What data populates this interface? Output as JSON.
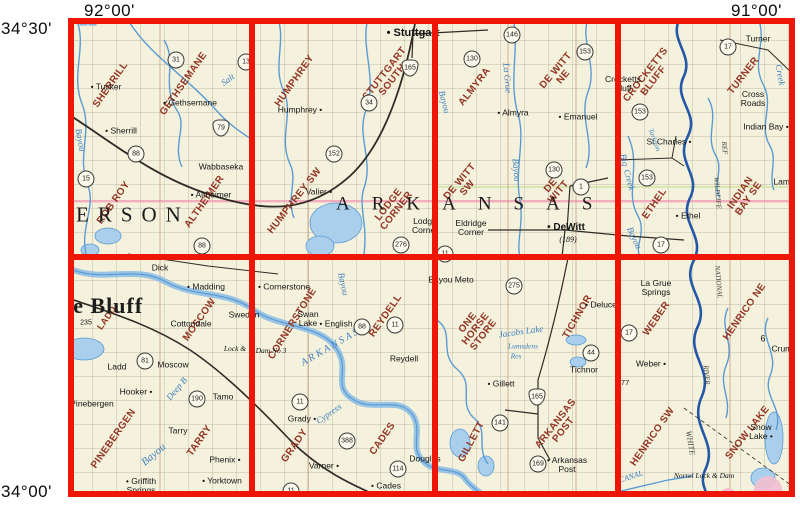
{
  "coord_labels": {
    "top_left_lon": "92°00'",
    "top_right_lon": "91°00'",
    "left_top_lat": "34°30'",
    "left_bottom_lat": "34°00'"
  },
  "map": {
    "bg": "#f4f2dc",
    "grid_color": "#ed1607",
    "quad_color": "#943525",
    "water_color": "#3f7fc1",
    "labels": {
      "quads": [
        {
          "lines": [
            "SHERRILL"
          ],
          "x": 43,
          "y": 67,
          "rot": -55
        },
        {
          "lines": [
            "GETHSEMANE"
          ],
          "x": 116,
          "y": 66,
          "rot": -55
        },
        {
          "lines": [
            "ROB ROY"
          ],
          "x": 46,
          "y": 185,
          "rot": -55
        },
        {
          "lines": [
            "ALTHEIMER"
          ],
          "x": 137,
          "y": 184,
          "rot": -55
        },
        {
          "lines": [
            "HUMPHREY"
          ],
          "x": 227,
          "y": 63,
          "rot": -55
        },
        {
          "lines": [
            "STUTTGART",
            "SOUTH"
          ],
          "x": 321,
          "y": 59,
          "rot": -52
        },
        {
          "lines": [
            "HUMPHREY SW"
          ],
          "x": 227,
          "y": 183,
          "rot": -52
        },
        {
          "lines": [
            "LODGE",
            "CORNER"
          ],
          "x": 325,
          "y": 190,
          "rot": -52
        },
        {
          "lines": [
            "ALMYRA"
          ],
          "x": 407,
          "y": 69,
          "rot": -52
        },
        {
          "lines": [
            "DE WITT",
            "NE"
          ],
          "x": 492,
          "y": 56,
          "rot": -50
        },
        {
          "lines": [
            "DE WITT",
            "SW"
          ],
          "x": 396,
          "y": 167,
          "rot": -50
        },
        {
          "lines": [
            "DE",
            "WITT"
          ],
          "x": 487,
          "y": 171,
          "rot": -50
        },
        {
          "lines": [
            "CROCKETTS",
            "BLUFF"
          ],
          "x": 582,
          "y": 60,
          "rot": -52
        },
        {
          "lines": [
            "TURNER"
          ],
          "x": 676,
          "y": 58,
          "rot": -52
        },
        {
          "lines": [
            "ETHEL"
          ],
          "x": 587,
          "y": 186,
          "rot": -55
        },
        {
          "lines": [
            "INDIAN",
            "BAY SE"
          ],
          "x": 677,
          "y": 178,
          "rot": -55
        },
        {
          "lines": [
            "LADD"
          ],
          "x": 39,
          "y": 300,
          "rot": -55,
          "size": 9
        },
        {
          "lines": [
            "MOSCOW"
          ],
          "x": 132,
          "y": 302,
          "rot": -55
        },
        {
          "lines": [
            "PINEBERGEN"
          ],
          "x": 46,
          "y": 421,
          "rot": -55
        },
        {
          "lines": [
            "TARRY"
          ],
          "x": 132,
          "y": 423,
          "rot": -55
        },
        {
          "lines": [
            "CORNERSTONE"
          ],
          "x": 225,
          "y": 306,
          "rot": -58
        },
        {
          "lines": [
            "REYDELL"
          ],
          "x": 318,
          "y": 298,
          "rot": -55
        },
        {
          "lines": [
            "GRADY"
          ],
          "x": 227,
          "y": 428,
          "rot": -55
        },
        {
          "lines": [
            "CADES"
          ],
          "x": 315,
          "y": 421,
          "rot": -55
        },
        {
          "lines": [
            "ONE",
            "HORSE",
            "STORE"
          ],
          "x": 408,
          "y": 311,
          "rot": -52
        },
        {
          "lines": [
            "TICHNOR"
          ],
          "x": 510,
          "y": 299,
          "rot": -60
        },
        {
          "lines": [
            "GILLETT"
          ],
          "x": 404,
          "y": 424,
          "rot": -62
        },
        {
          "lines": [
            "ARKANSAS",
            "POST"
          ],
          "x": 492,
          "y": 409,
          "rot": -52
        },
        {
          "lines": [
            "WEBER"
          ],
          "x": 589,
          "y": 301,
          "rot": -55
        },
        {
          "lines": [
            "HENRICO NE"
          ],
          "x": 677,
          "y": 294,
          "rot": -55
        },
        {
          "lines": [
            "HENRICO SW"
          ],
          "x": 585,
          "y": 419,
          "rot": -55
        },
        {
          "lines": [
            "SNOW LAKE"
          ],
          "x": 680,
          "y": 415,
          "rot": -52
        }
      ],
      "towns": [
        {
          "t": "Tucker",
          "x": 38,
          "y": 69,
          "dot": "left"
        },
        {
          "t": "Gethsemane",
          "x": 122,
          "y": 85,
          "dot": "left"
        },
        {
          "t": "Sherrill",
          "x": 53,
          "y": 113,
          "dot": "left"
        },
        {
          "t": "Wabbaseka",
          "x": 153,
          "y": 149
        },
        {
          "t": "Altheimer",
          "x": 143,
          "y": 177,
          "dot": "left"
        },
        {
          "t": "Stuttgart",
          "x": 345,
          "y": 16,
          "dot": "left",
          "size": 11,
          "b": true
        },
        {
          "t": "Humphrey",
          "x": 232,
          "y": 92,
          "dot": "right"
        },
        {
          "t": "Valier",
          "x": 251,
          "y": 174,
          "dot": "right"
        },
        {
          "lines": [
            "Lodge",
            "Corner"
          ],
          "x": 357,
          "y": 208
        },
        {
          "lines": [
            "Eldridge",
            "Corner"
          ],
          "x": 403,
          "y": 210
        },
        {
          "t": "Almyra",
          "x": 445,
          "y": 95,
          "dot": "left"
        },
        {
          "t": "Emanuel",
          "x": 510,
          "y": 99,
          "dot": "left"
        },
        {
          "t": "DeWitt",
          "x": 498,
          "y": 210,
          "dot": "left",
          "size": 10,
          "b": true
        },
        {
          "t": "(189)",
          "x": 500,
          "y": 222,
          "i": true,
          "size": 8
        },
        {
          "lines": [
            "Crocketts",
            "Bluff"
          ],
          "x": 555,
          "y": 66
        },
        {
          "t": "Turner",
          "x": 690,
          "y": 21
        },
        {
          "lines": [
            "Cross",
            "Roads"
          ],
          "x": 685,
          "y": 81
        },
        {
          "t": "Indian Bay",
          "x": 698,
          "y": 109,
          "dot": "right"
        },
        {
          "t": "St Charles",
          "x": 601,
          "y": 124,
          "dot": "right"
        },
        {
          "t": "Ethel",
          "x": 620,
          "y": 198,
          "dot": "left"
        },
        {
          "t": "Lamb",
          "x": 716,
          "y": 164
        },
        {
          "t": "Dick",
          "x": 92,
          "y": 250
        },
        {
          "t": "Madding",
          "x": 138,
          "y": 269,
          "dot": "left"
        },
        {
          "t": "Cottondale",
          "x": 123,
          "y": 306
        },
        {
          "t": "Sweden",
          "x": 176,
          "y": 297
        },
        {
          "t": "Ladd",
          "x": 49,
          "y": 349
        },
        {
          "t": "Moscow",
          "x": 105,
          "y": 347
        },
        {
          "t": "Lock &",
          "x": 167,
          "y": 331,
          "size": 7.5,
          "i": true
        },
        {
          "t": "Hooker",
          "x": 68,
          "y": 374,
          "dot": "right"
        },
        {
          "t": "Pinebergen",
          "x": 24,
          "y": 386
        },
        {
          "t": "Tamo",
          "x": 155,
          "y": 379
        },
        {
          "t": "Tarry",
          "x": 110,
          "y": 413
        },
        {
          "t": "Phenix",
          "x": 157,
          "y": 442,
          "dot": "right"
        },
        {
          "t": "Yorktown",
          "x": 154,
          "y": 463,
          "dot": "left"
        },
        {
          "lines": [
            "Griffith",
            "Springs"
          ],
          "x": 73,
          "y": 468,
          "dot": "left"
        },
        {
          "t": "Cornerstone",
          "x": 216,
          "y": 269,
          "dot": "left"
        },
        {
          "lines": [
            "Swan",
            "Lake"
          ],
          "x": 240,
          "y": 301
        },
        {
          "t": "English",
          "x": 268,
          "y": 306,
          "dot": "left"
        },
        {
          "t": "Dam No 3",
          "x": 203,
          "y": 333,
          "size": 7.5,
          "i": true
        },
        {
          "t": "Reydell",
          "x": 336,
          "y": 341
        },
        {
          "t": "Grady",
          "x": 234,
          "y": 401,
          "dot": "right"
        },
        {
          "t": "Varner",
          "x": 256,
          "y": 448,
          "dot": "right"
        },
        {
          "t": "Cades",
          "x": 318,
          "y": 468,
          "dot": "left"
        },
        {
          "t": "Douglas",
          "x": 357,
          "y": 441
        },
        {
          "t": "Bayou Meto",
          "x": 383,
          "y": 262
        },
        {
          "t": "Deluce",
          "x": 533,
          "y": 287,
          "dot": "left"
        },
        {
          "t": "Tichnor",
          "x": 516,
          "y": 352
        },
        {
          "t": "Gillett",
          "x": 433,
          "y": 366,
          "dot": "left"
        },
        {
          "lines": [
            "Arkansas",
            "Post"
          ],
          "x": 499,
          "y": 447,
          "dot": "left"
        },
        {
          "lines": [
            "La Grue",
            "Springs"
          ],
          "x": 588,
          "y": 270
        },
        {
          "t": "Weber",
          "x": 583,
          "y": 346,
          "dot": "right"
        },
        {
          "t": "Crumrod",
          "x": 720,
          "y": 331
        },
        {
          "t": "6",
          "x": 695,
          "y": 321,
          "size": 9
        },
        {
          "lines": [
            "Snow",
            "Lake"
          ],
          "x": 693,
          "y": 414,
          "dot": "right"
        },
        {
          "t": "Norrel Lock & Dam",
          "x": 636,
          "y": 458,
          "size": 7.5,
          "i": true
        },
        {
          "t": "177",
          "x": 555,
          "y": 365,
          "size": 7.5
        },
        {
          "t": "235",
          "x": 18,
          "y": 305,
          "size": 7
        }
      ],
      "shields": [
        {
          "n": "31",
          "x": 108,
          "y": 42
        },
        {
          "n": "13",
          "x": 178,
          "y": 44
        },
        {
          "n": "79",
          "x": 153,
          "y": 110,
          "us": true
        },
        {
          "n": "88",
          "x": 68,
          "y": 136
        },
        {
          "n": "15",
          "x": 18,
          "y": 161
        },
        {
          "n": "88",
          "x": 134,
          "y": 228
        },
        {
          "n": "165",
          "x": 342,
          "y": 50,
          "us": true
        },
        {
          "n": "34",
          "x": 301,
          "y": 85
        },
        {
          "n": "152",
          "x": 266,
          "y": 136
        },
        {
          "n": "276",
          "x": 333,
          "y": 227
        },
        {
          "n": "130",
          "x": 404,
          "y": 41
        },
        {
          "n": "146",
          "x": 444,
          "y": 17
        },
        {
          "n": "153",
          "x": 517,
          "y": 34
        },
        {
          "n": "130",
          "x": 486,
          "y": 152
        },
        {
          "n": "1",
          "x": 513,
          "y": 169
        },
        {
          "n": "11",
          "x": 377,
          "y": 236
        },
        {
          "n": "17",
          "x": 660,
          "y": 29
        },
        {
          "n": "153",
          "x": 572,
          "y": 94
        },
        {
          "n": "153",
          "x": 579,
          "y": 160
        },
        {
          "n": "17",
          "x": 593,
          "y": 227
        },
        {
          "n": "81",
          "x": 77,
          "y": 343
        },
        {
          "n": "190",
          "x": 129,
          "y": 381
        },
        {
          "n": "88",
          "x": 294,
          "y": 309
        },
        {
          "n": "11",
          "x": 327,
          "y": 307
        },
        {
          "n": "11",
          "x": 232,
          "y": 384
        },
        {
          "n": "388",
          "x": 279,
          "y": 423
        },
        {
          "n": "114",
          "x": 330,
          "y": 451
        },
        {
          "n": "11",
          "x": 223,
          "y": 473
        },
        {
          "n": "275",
          "x": 446,
          "y": 268
        },
        {
          "n": "44",
          "x": 523,
          "y": 335
        },
        {
          "n": "165",
          "x": 469,
          "y": 379,
          "us": true
        },
        {
          "n": "141",
          "x": 432,
          "y": 405
        },
        {
          "n": "169",
          "x": 470,
          "y": 446
        },
        {
          "n": "17",
          "x": 561,
          "y": 315
        }
      ],
      "waters": [
        {
          "t": "Salt",
          "x": 160,
          "y": 62,
          "rot": -35
        },
        {
          "t": "Bayou",
          "x": 12,
          "y": 122,
          "rot": 80
        },
        {
          "t": "La Grue",
          "x": 439,
          "y": 60,
          "rot": 85
        },
        {
          "t": "Bayou",
          "x": 448,
          "y": 152,
          "rot": 85
        },
        {
          "t": "Bayou",
          "x": 376,
          "y": 84,
          "rot": 75
        },
        {
          "t": "Creek",
          "x": 712,
          "y": 57,
          "rot": 80
        },
        {
          "t": "Big",
          "x": 556,
          "y": 142,
          "rot": 75
        },
        {
          "t": "Creek",
          "x": 561,
          "y": 162,
          "rot": 75
        },
        {
          "t": "Tarleton",
          "x": 586,
          "y": 122,
          "rot": 70,
          "size": 7
        },
        {
          "t": "Bayou",
          "x": 566,
          "y": 220,
          "rot": 65
        },
        {
          "t": "Deep B",
          "x": 109,
          "y": 371,
          "rot": -50
        },
        {
          "t": "Bayou",
          "x": 86,
          "y": 437,
          "rot": -40,
          "size": 11
        },
        {
          "t": "A R K A N S A S",
          "x": 262,
          "y": 330,
          "rot": -30,
          "size": 10
        },
        {
          "t": "Bayou",
          "x": 275,
          "y": 266,
          "rot": 78
        },
        {
          "t": "Cypress",
          "x": 261,
          "y": 396,
          "rot": -35
        },
        {
          "t": "Jacobs Lake",
          "x": 453,
          "y": 314,
          "rot": -8
        },
        {
          "t": "Lumsdens",
          "x": 455,
          "y": 328,
          "rot": 0,
          "size": 7.5
        },
        {
          "t": "Res",
          "x": 448,
          "y": 338,
          "rot": 0,
          "size": 7.5
        },
        {
          "t": "CANAL",
          "x": 563,
          "y": 459,
          "rot": -18,
          "size": 8
        },
        {
          "t": "WILDLIFE",
          "x": 649,
          "y": 175,
          "rot": 85,
          "c": "#3c3c3c",
          "size": 7
        },
        {
          "t": "REF",
          "x": 656,
          "y": 130,
          "rot": 85,
          "c": "#3c3c3c",
          "size": 7
        },
        {
          "t": "NATIONAL",
          "x": 650,
          "y": 264,
          "rot": 85,
          "c": "#3c3c3c",
          "size": 7
        },
        {
          "t": "RIVER",
          "x": 638,
          "y": 357,
          "rot": 85,
          "c": "#3c3c3c",
          "size": 7
        },
        {
          "t": "WHITE",
          "x": 622,
          "y": 425,
          "rot": 80,
          "c": "#3c3c3c",
          "size": 8
        }
      ],
      "bigs": [
        {
          "t": "ERSON",
          "x": 8,
          "y": 197,
          "size": 21,
          "ls": 9
        },
        {
          "t": "ARKANSAS",
          "x": 268,
          "y": 186,
          "size": 19,
          "ls": 22
        },
        {
          "t": "ne Bluff",
          "x": -8,
          "y": 288,
          "size": 22,
          "ls": 1,
          "b": true
        }
      ]
    }
  }
}
